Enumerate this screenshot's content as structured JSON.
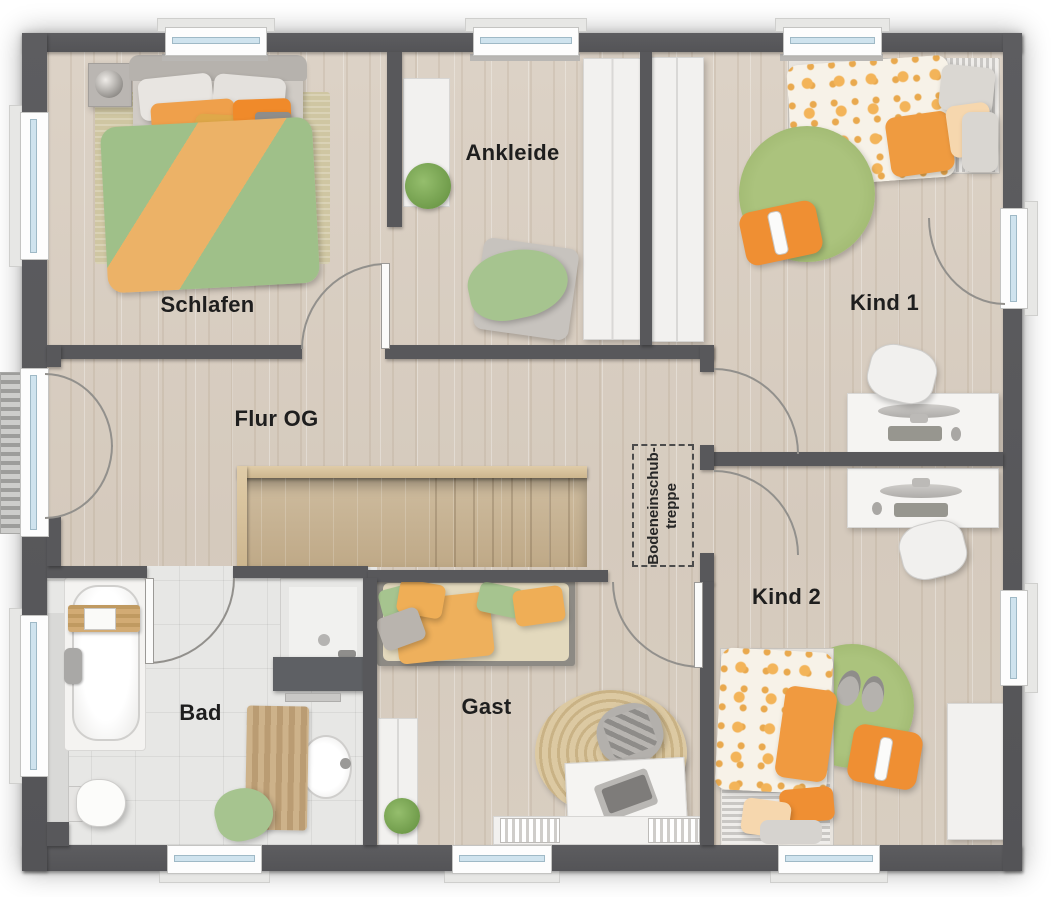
{
  "floorplan": {
    "rooms": {
      "schlafen": {
        "label": "Schlafen"
      },
      "ankleide": {
        "label": "Ankleide"
      },
      "kind1": {
        "label": "Kind 1"
      },
      "flur": {
        "label": "Flur OG"
      },
      "bad": {
        "label": "Bad"
      },
      "gast": {
        "label": "Gast"
      },
      "kind2": {
        "label": "Kind 2"
      },
      "attic": {
        "label": "Bodeneinschub-\ntreppe"
      }
    },
    "palette": {
      "wall_gray": "#58585b",
      "floor_wood": "#d8cec2",
      "floor_tile": "#e7e7e5",
      "stair_wood": "#c4ae8e",
      "accent_green": "#a6c48f",
      "accent_orange": "#efa04b",
      "window_glass": "#cfe3ee"
    }
  }
}
